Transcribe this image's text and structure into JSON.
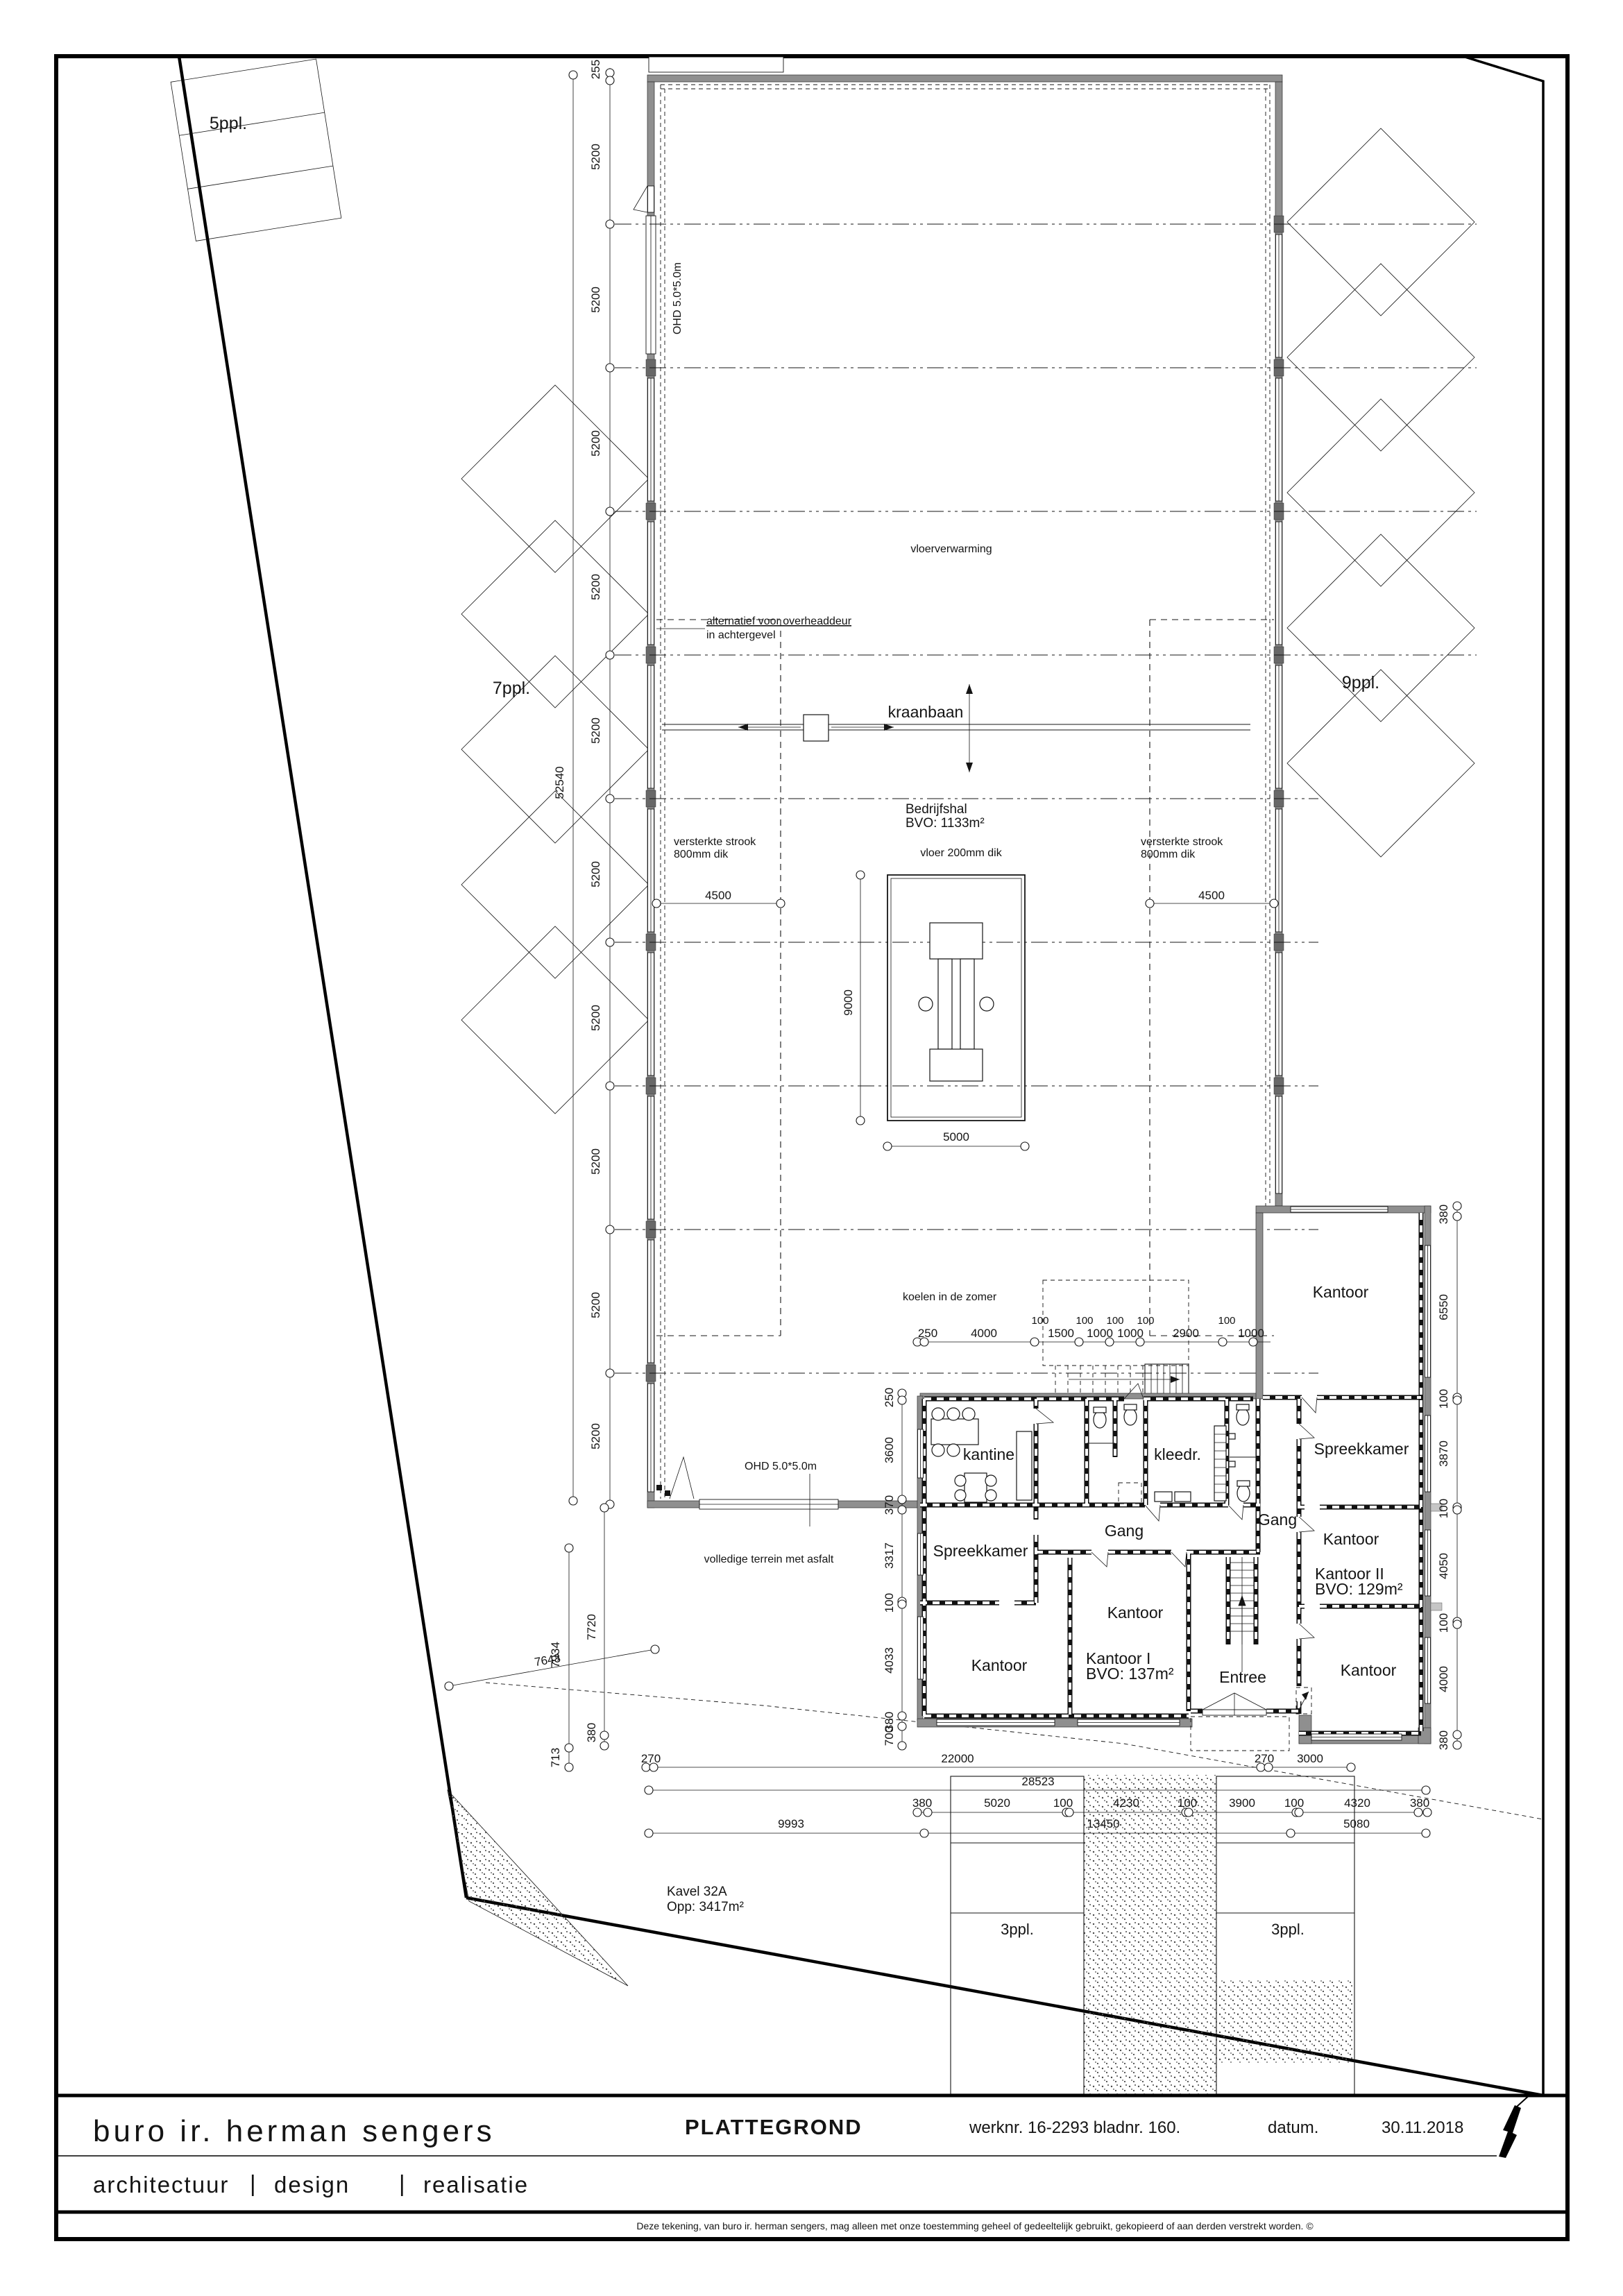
{
  "title_block": {
    "brand": "buro ir. herman sengers",
    "doc_type": "PLATTEGROND",
    "werknr": "werknr. 16-2293 bladnr. 160.",
    "datum_label": "datum.",
    "datum_value": "30.11.2018",
    "tagline": [
      "architectuur",
      "design",
      "realisatie"
    ],
    "tagline_separator": "|",
    "accent_color": "#5d8f1e",
    "disclaimer": "Deze tekening, van buro ir. herman sengers, mag alleen met onze toestemming geheel of gedeeltelijk gebruikt, gekopieerd of aan derden verstrekt worden. ©"
  },
  "plan": {
    "parking": {
      "p5": "5ppl.",
      "p7": "7ppl.",
      "p9": "9ppl.",
      "p3_left": "3ppl.",
      "p3_right": "3ppl."
    },
    "hall": {
      "name": "Bedrijfshal",
      "bvo": "BVO: 1133m²",
      "floor_heating": "vloerverwarming",
      "crane": "kraanbaan",
      "floor_note": "vloer 200mm dik",
      "strip_note_1": "versterkte strook",
      "strip_note_2": "800mm dik",
      "cooling_note": "koelen in de zomer",
      "ohd_door": "OHD 5.0*5.0m",
      "alt_note_1": "alternatief voor overheaddeur",
      "alt_note_2": "in achtergevel"
    },
    "office": {
      "kantine": "kantine",
      "kleedruimte": "kleedr.",
      "spreekkamer": "Spreekkamer",
      "gang": "Gang",
      "kantoor": "Kantoor",
      "kantoor1": "Kantoor  I",
      "kantoor1_bvo": "BVO: 137m²",
      "kantoor2": "Kantoor  II",
      "kantoor2_bvo": "BVO: 129m²",
      "entree": "Entree"
    },
    "site": {
      "kavel": "Kavel  32A",
      "opp": "Opp:      3417m²",
      "asphalt_note": "volledige  terrein  met  asfalt"
    },
    "dims": {
      "left_first": "255",
      "left_bay": "5200",
      "left_total": "52540",
      "strip_width": "4500",
      "pit_width": "5000",
      "pit_depth": "9000",
      "top_chain_upper": [
        "100",
        "100",
        "100",
        "100",
        "100"
      ],
      "top_chain": [
        "250",
        "4000",
        "1500",
        "1000",
        "1000",
        "2900",
        "1000"
      ],
      "right_chain": [
        "380",
        "6550",
        "100",
        "3870",
        "100",
        "4050",
        "100",
        "4000",
        "380"
      ],
      "left_chain": [
        "250",
        "3600",
        "370",
        "3317",
        "100",
        "4033",
        "380",
        "700"
      ],
      "terrain": [
        "7934",
        "7720",
        "713",
        "380",
        "7643"
      ],
      "chain_a": [
        "270",
        "22000",
        "270",
        "3000"
      ],
      "total_b": "28523",
      "chain_c": [
        "380",
        "5020",
        "100",
        "4230",
        "100",
        "3900",
        "100",
        "4320",
        "380"
      ],
      "chain_d": [
        "9993",
        "13450",
        "5080"
      ]
    }
  }
}
